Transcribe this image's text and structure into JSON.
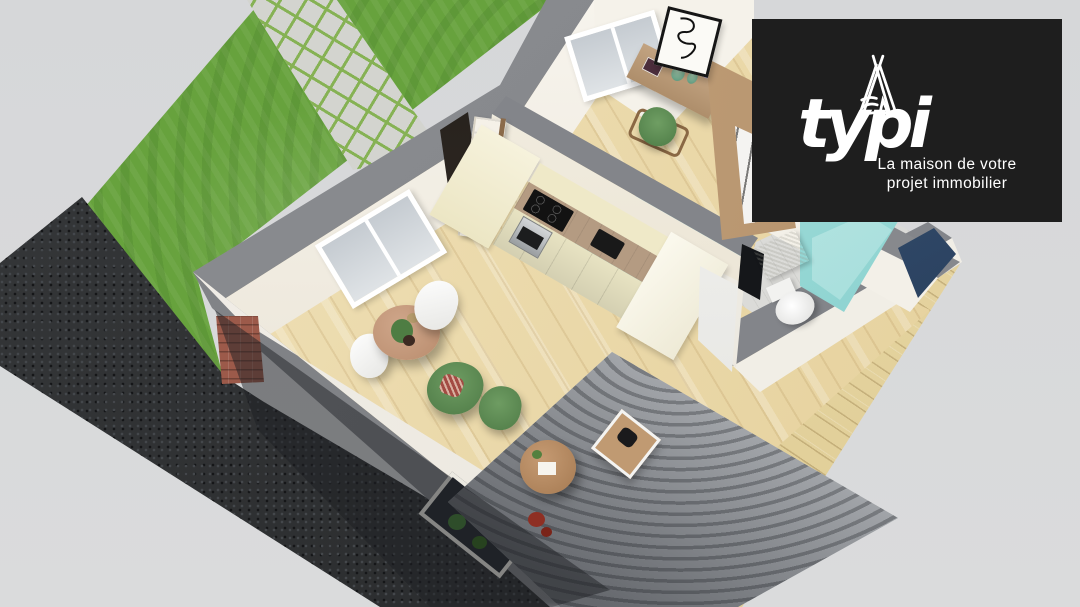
{
  "logo": {
    "brand": "typi",
    "tagline_line1": "La maison de votre",
    "tagline_line2": "projet immobilier",
    "icon": "teepee-icon",
    "background": "#1e1e1e",
    "text_color": "#ffffff"
  },
  "palette": {
    "canvas_bg": "#d7d8da",
    "lawn_green": "#67a23d",
    "paver_gray": "#d3d4cf",
    "paver_joint_green": "#86b254",
    "asphalt_dark": "#2b2d2f",
    "wall_top_gray": "#85878b",
    "wall_face_white": "#f4f1ea",
    "interior_floor_wood": "#ecd9a4",
    "deck_wood": "#e6d5a4",
    "kitchen_cabinet_cream": "#f1ecca",
    "counter_wood": "#b49b82",
    "rug_teal": "#4fb2bf",
    "rug_gray": "#b4b7bb",
    "shower_teal": "#7fd0cf",
    "brick_red": "#9c5a4a",
    "seat_green": "#5c8a53",
    "table_wood": "#c0926c",
    "window_blue": "#3a5a80"
  }
}
